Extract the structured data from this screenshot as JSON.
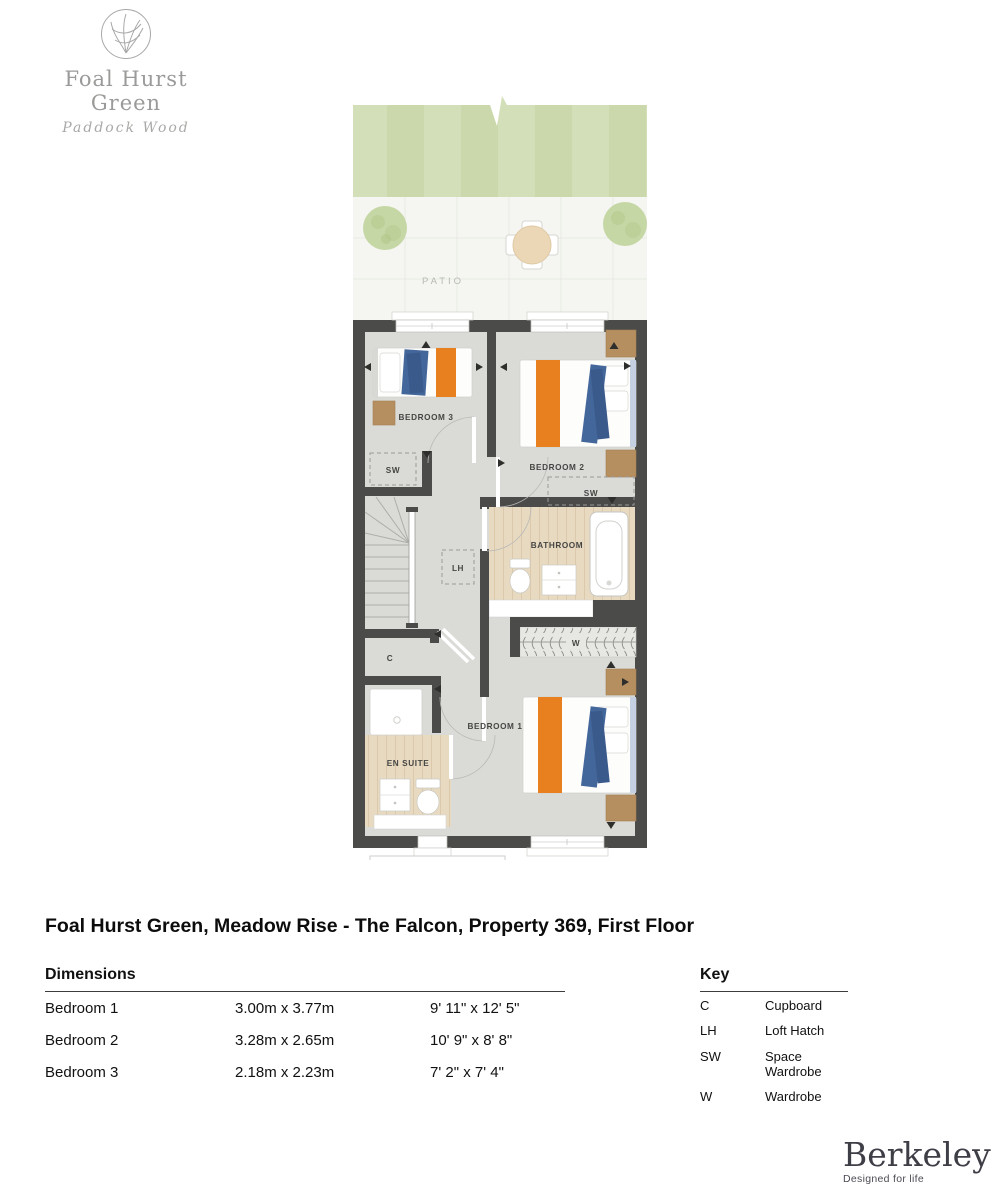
{
  "logo": {
    "name": "Foal Hurst Green",
    "subtitle": "Paddock Wood"
  },
  "garden": {
    "patio_label": "PATIO"
  },
  "rooms": {
    "bedroom1": "BEDROOM 1",
    "bedroom2": "BEDROOM 2",
    "bedroom3": "BEDROOM 3",
    "bathroom": "BATHROOM",
    "ensuite": "EN SUITE",
    "cupboard": "C",
    "loft_hatch": "LH",
    "space_wardrobe": "SW",
    "wardrobe": "W"
  },
  "title": "Foal Hurst Green, Meadow Rise - The Falcon, Property 369, First Floor",
  "dimensions": {
    "heading": "Dimensions",
    "rows": [
      {
        "room": "Bedroom 1",
        "metric": "3.00m x 3.77m",
        "imperial": "9' 11\" x 12' 5\""
      },
      {
        "room": "Bedroom 2",
        "metric": "3.28m x 2.65m",
        "imperial": "10' 9\" x 8' 8\""
      },
      {
        "room": "Bedroom 3",
        "metric": "2.18m x 2.23m",
        "imperial": "7' 2\" x 7' 4\""
      }
    ]
  },
  "key": {
    "heading": "Key",
    "entries": [
      {
        "abbr": "C",
        "label": "Cupboard"
      },
      {
        "abbr": "LH",
        "label": "Loft Hatch"
      },
      {
        "abbr": "SW",
        "label": "Space Wardrobe"
      },
      {
        "abbr": "W",
        "label": "Wardrobe"
      }
    ]
  },
  "brand": {
    "name": "Berkeley",
    "tagline": "Designed for life"
  },
  "colors": {
    "wall": "#4b4b49",
    "floor": "#dadad7",
    "wood_floor": "#e8dac1",
    "accent_orange": "#e8801f",
    "accent_blue": "#44679b",
    "furniture_wood": "#b68f60",
    "lawn": "#d2deb6",
    "patio": "#f5f6f2"
  }
}
